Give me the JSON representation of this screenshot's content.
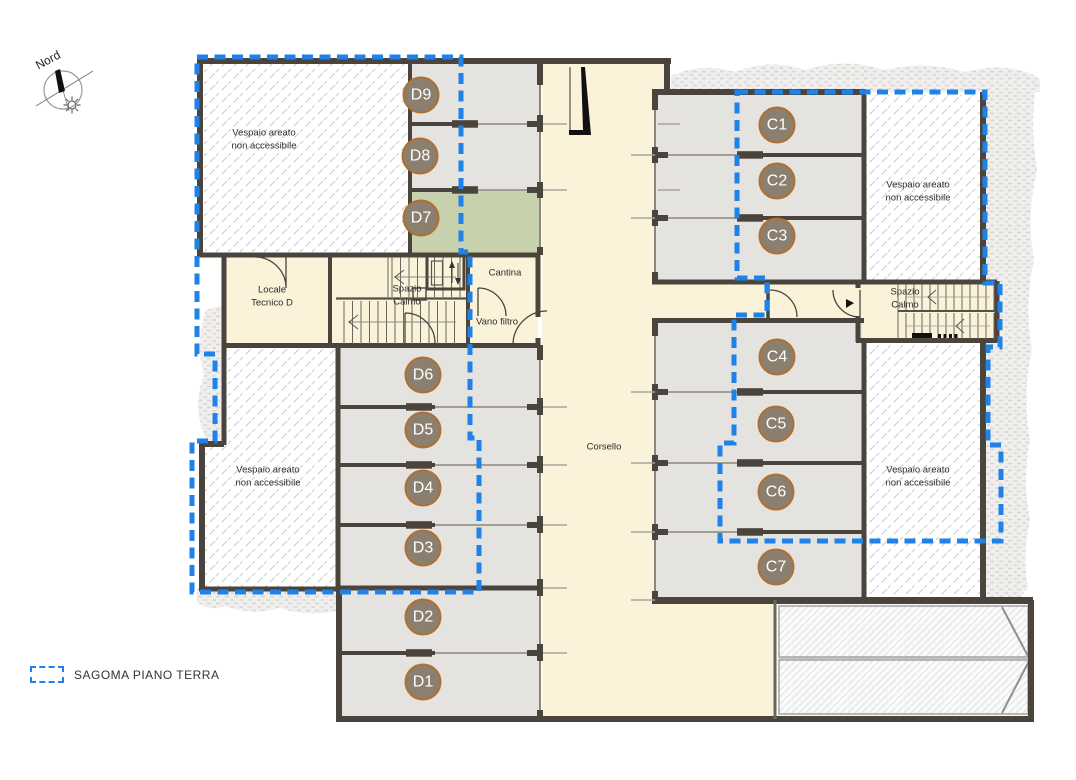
{
  "compass": {
    "label": "Nord"
  },
  "legend": {
    "label": "SAGOMA PIANO TERRA"
  },
  "corridor": {
    "label": "Corsello"
  },
  "rooms": {
    "vespaio_top_left": "Vespaio areato\nnon accessibile",
    "vespaio_top_right": "Vespaio areato\nnon accessibile",
    "vespaio_bottom_left": "Vespaio areato\nnon accessibile",
    "vespaio_bottom_right": "Vespaio areato\nnon accessibile",
    "locale_tecnico": "Locale\nTecnico D",
    "spazio_calmo_left": "Spazio\nCalmo",
    "spazio_calmo_right": "Spazio\nCalmo",
    "cantina": "Cantina",
    "vano_filtro": "Vano filtro"
  },
  "parking_spaces": [
    {
      "label": "D9"
    },
    {
      "label": "D8"
    },
    {
      "label": "D7"
    },
    {
      "label": "D6"
    },
    {
      "label": "D5"
    },
    {
      "label": "D4"
    },
    {
      "label": "D3"
    },
    {
      "label": "D2"
    },
    {
      "label": "D1"
    },
    {
      "label": "C1"
    },
    {
      "label": "C2"
    },
    {
      "label": "C3"
    },
    {
      "label": "C4"
    },
    {
      "label": "C5"
    },
    {
      "label": "C6"
    },
    {
      "label": "C7"
    }
  ],
  "colors": {
    "sagoma_blue": "#1e82e8",
    "wall": "#4a443c",
    "parking_fill": "#e4e3e0",
    "corridor_fill": "#faf3da",
    "unit_d7_green": "#c7d1ae",
    "badge_fill": "#8b8070",
    "badge_ring": "#b06f2d"
  }
}
